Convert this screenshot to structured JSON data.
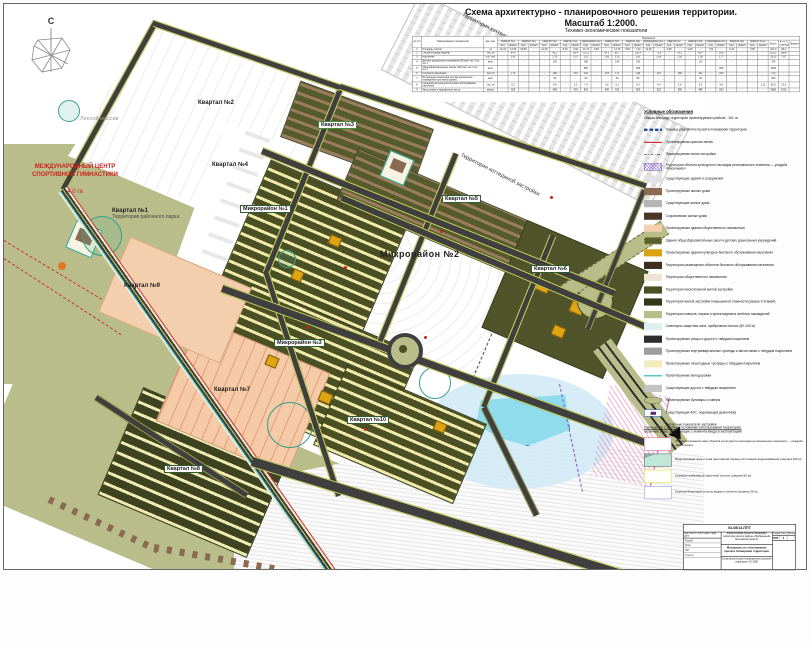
{
  "title": {
    "line1": "Схема архитектурно - планировочного решения территории.",
    "line2": "Масштаб 1:2000.",
    "table_caption": "Технико-экономические показатели"
  },
  "compass": {
    "north": "С"
  },
  "map": {
    "labels": [
      {
        "text": "Квартал №2",
        "x": 194,
        "y": 96,
        "cls": "plain"
      },
      {
        "text": "Квартал №4",
        "x": 208,
        "y": 158,
        "cls": "plain"
      },
      {
        "text": "Квартал №1",
        "sub": "Территория районного парка",
        "x": 108,
        "y": 204,
        "cls": "plain"
      },
      {
        "text": "Квартал №3",
        "x": 314,
        "y": 117,
        "cls": "gbox"
      },
      {
        "text": "Квартал №9",
        "x": 120,
        "y": 279,
        "cls": "plain"
      },
      {
        "text": "Квартал №5",
        "x": 438,
        "y": 191,
        "cls": "dbox"
      },
      {
        "text": "Квартал №6",
        "x": 527,
        "y": 261,
        "cls": "dbox"
      },
      {
        "text": "Квартал №7",
        "x": 210,
        "y": 383,
        "cls": "plain"
      },
      {
        "text": "Квартал №8",
        "x": 160,
        "y": 461,
        "cls": "dbox"
      },
      {
        "text": "Квартал №10",
        "x": 343,
        "y": 412,
        "cls": "dbox"
      },
      {
        "text": "Микрорайон №1",
        "x": 236,
        "y": 201,
        "cls": "dbox"
      },
      {
        "text": "Микрорайон №2",
        "x": 376,
        "y": 246,
        "cls": "big"
      },
      {
        "text": "Микрорайон №3",
        "x": 270,
        "y": 335,
        "cls": "dbox"
      },
      {
        "text": "Территория коттеджного поселка «Людмила»",
        "x": 452,
        "y": 34,
        "cls": "rotated",
        "rot": 27
      },
      {
        "text": "Территория коттеджной застройки",
        "x": 452,
        "y": 168,
        "cls": "rotated",
        "rot": 27
      },
      {
        "text": "Лесной массив",
        "x": 76,
        "y": 112,
        "cls": "forest"
      }
    ],
    "intl_center": {
      "line1": "МЕЖДУНАРОДНЫЙ ЦЕНТР",
      "line2": "СПОРТИВНОЙ ГИМНАСТИКИ",
      "area": "4,0 га"
    }
  },
  "table": {
    "top_header": "Показатели",
    "corner_headers": [
      "№ п/п",
      "Наименование показателей",
      "Ед. изм."
    ],
    "sub_cycle": [
      "сущ.",
      "проект."
    ],
    "groups": [
      {
        "label": "Квартал №1",
        "span": 2
      },
      {
        "label": "Квартал №2",
        "span": 2
      },
      {
        "label": "Квартал №3",
        "span": 2
      },
      {
        "label": "Квартал №4",
        "span": 2
      },
      {
        "label": "Микрорайон №1",
        "span": 2
      },
      {
        "label": "Квартал №5",
        "span": 2
      },
      {
        "label": "Квартал №6",
        "span": 2
      },
      {
        "label": "Микрорайон №2",
        "span": 2
      },
      {
        "label": "Квартал №7",
        "span": 2
      },
      {
        "label": "Квартал №8",
        "span": 2
      },
      {
        "label": "Микрорайон №3",
        "span": 2
      },
      {
        "label": "Квартал №9",
        "span": 2
      },
      {
        "label": "Квартал №10",
        "span": 2
      },
      {
        "label": "Всего",
        "span": 1
      },
      {
        "label": "в т.ч. 1 очередь",
        "span": 1
      },
      {
        "label": "Примечание",
        "span": 1
      }
    ],
    "rows": [
      {
        "num": "1",
        "name": "Площадь участка",
        "unit": "га",
        "values": [
          "10,44",
          "13,96",
          "63,80",
          "-",
          "12,08",
          "-",
          "8,20",
          "4,66",
          "10,73",
          "9,66",
          "-",
          "14,78",
          "5,95",
          "7,40",
          "12,28",
          "-",
          "4,85",
          "-",
          "9,06",
          "-",
          "7,52",
          "-",
          "6,42",
          "-",
          "3,80",
          "-",
          "161,0",
          "48,2",
          ""
        ]
      },
      {
        "num": "2",
        "name": "Общая площадь квартир",
        "unit": "тыс. м²",
        "values": [
          "-",
          "84,6",
          "-",
          "-",
          "-",
          "96,2",
          "-",
          "58,4",
          "112,5",
          "-",
          "64,2",
          "88,7",
          "-",
          "126,4",
          "-",
          "72,8",
          "-",
          "54,2",
          "-",
          "68,4",
          "-",
          "96,8",
          "-",
          "-",
          "-",
          "-",
          "823,2",
          "268,4",
          ""
        ]
      },
      {
        "num": "3",
        "name": "Население",
        "unit": "тыс. чел.",
        "values": [
          "-",
          "2,42",
          "-",
          "-",
          "-",
          "2,75",
          "-",
          "1,67",
          "3,21",
          "-",
          "1,83",
          "2,53",
          "-",
          "3,61",
          "-",
          "2,08",
          "-",
          "1,55",
          "-",
          "1,95",
          "-",
          "2,77",
          "-",
          "-",
          "-",
          "-",
          "23,52",
          "7,67",
          ""
        ]
      },
      {
        "num": "4",
        "name": "Детские дошкольные учреждения (55 мест на 1 тыс. чел.)",
        "unit": "мест",
        "values": [
          "-",
          "-",
          "-",
          "-",
          "-",
          "135",
          "-",
          "-",
          "180",
          "-",
          "-",
          "140",
          "-",
          "200",
          "-",
          "-",
          "-",
          "-",
          "-",
          "110",
          "-",
          "-",
          "-",
          "-",
          "-",
          "-",
          "765",
          "-",
          ""
        ]
      },
      {
        "num": "5",
        "name": "Общеобразовательные школы (135 мест на 1 тыс. чел.)",
        "unit": "мест",
        "values": [
          "-",
          "-",
          "-",
          "-",
          "-",
          "-",
          "-",
          "-",
          "550",
          "-",
          "-",
          "-",
          "-",
          "825",
          "-",
          "-",
          "-",
          "-",
          "-",
          "-",
          "-",
          "550",
          "-",
          "-",
          "-",
          "-",
          "1925",
          "-",
          ""
        ]
      },
      {
        "num": "6",
        "name": "Плотность населения",
        "unit": "чел./га",
        "values": [
          "-",
          "173",
          "-",
          "-",
          "-",
          "186",
          "-",
          "204",
          "192",
          "-",
          "178",
          "171",
          "-",
          "146",
          "-",
          "210",
          "-",
          "168",
          "-",
          "162",
          "-",
          "184",
          "-",
          "-",
          "-",
          "-",
          "176",
          "-",
          ""
        ]
      },
      {
        "num": "7",
        "name": "Встроенные помещения детских дошкольных учреждений (при жилых домах)",
        "unit": "мест",
        "values": [
          "-",
          "-",
          "-",
          "-",
          "-",
          "40",
          "-",
          "-",
          "60",
          "-",
          "-",
          "40",
          "-",
          "80",
          "-",
          "-",
          "-",
          "-",
          "-",
          "40",
          "-",
          "-",
          "-",
          "-",
          "-",
          "-",
          "260",
          "-",
          ""
        ]
      },
      {
        "num": "8",
        "name": "Предприятия культурно-бытового обслуживания населения",
        "unit": "тыс. м²",
        "values": [
          "-",
          "6,2",
          "-",
          "-",
          "-",
          "4,8",
          "-",
          "3,2",
          "7,4",
          "-",
          "3,6",
          "5,1",
          "-",
          "8,2",
          "-",
          "4,4",
          "-",
          "2,8",
          "-",
          "3,5",
          "-",
          "5,6",
          "-",
          "-",
          "-",
          "1,12",
          "56,0",
          "12,6",
          ""
        ]
      },
      {
        "num": "9",
        "name": "Автостоянки и парковочные места",
        "unit": "м/мест",
        "values": [
          "-",
          "605",
          "-",
          "-",
          "-",
          "688",
          "-",
          "418",
          "803",
          "-",
          "458",
          "633",
          "-",
          "903",
          "-",
          "520",
          "-",
          "388",
          "-",
          "488",
          "-",
          "693",
          "-",
          "-",
          "-",
          "-",
          "5880",
          "1916",
          ""
        ]
      }
    ]
  },
  "legend": {
    "header": "Условные обозначения",
    "area_note": "Общая площадь территории проектируемого района - 161 га",
    "items": [
      {
        "sw": "sw-blue-dash",
        "line": true,
        "label": "Граница разработки проекта планировки территории"
      },
      {
        "sw": "sw-red",
        "line": true,
        "label": "Проектируемая красная линия"
      },
      {
        "sw": "sw-dashdot",
        "line": true,
        "label": "Проектируемая линия застройки"
      },
      {
        "sw": "sw-hatch-purple",
        "label": "Территория объекта культурного наследия регионального значения — усадьба «Васильево»"
      },
      {
        "sw": "sw-ltgray",
        "label": "Существующие здания и сооружения"
      },
      {
        "sw": "sw-brown",
        "label": "Проектируемые жилые дома"
      },
      {
        "sw": "sw-gray",
        "label": "Существующие жилые дома"
      },
      {
        "sw": "sw-dkbrown",
        "label": "Сохраняемые жилые дома"
      },
      {
        "sw": "sw-peach",
        "label": "Проектируемые здания общественного назначения"
      },
      {
        "sw": "sw-olive-dash",
        "label": "Здания общеобразовательных школ и детских дошкольных учреждений"
      },
      {
        "sw": "sw-gold",
        "label": "Проектируемые здания культурно-бытового обслуживания населения"
      },
      {
        "sw": "sw-dkbrown2",
        "label": "Территория размещения объектов бытового обслуживания населения"
      },
      {
        "sw": "sw-cream",
        "label": "Территория общественного назначения"
      },
      {
        "sw": "sw-dkolive",
        "label": "Территория многоэтажной жилой застройки"
      },
      {
        "sw": "sw-dkolive2",
        "label": "Территория жилой застройки повышенной этажности (свыше 9 этажей)"
      },
      {
        "sw": "sw-khaki",
        "label": "Территория скверов, парков и проектируемых зелёных насаждений"
      },
      {
        "sw": "sw-ltcyan",
        "label": "Санитарно-защитная зона, прибрежная полоса (50-100 м)"
      },
      {
        "sw": "sw-black",
        "label": "Проектируемые улицы и дороги с твёрдым покрытием"
      },
      {
        "sw": "sw-midgray",
        "label": "Проектируемые внутриквартальные проезды и автостоянки с твёрдым покрытием"
      },
      {
        "sw": "sw-paleyellow",
        "label": "Проектируемые пешеходные тротуары с твёрдым покрытием"
      },
      {
        "sw": "sw-cyan",
        "line": true,
        "label": "Проектируемые велодорожки"
      },
      {
        "sw": "sw-gray2",
        "label": "Существующие дороги с твёрдым покрытием"
      },
      {
        "sw": "sw-oval",
        "label": "Проектируемые бульвары и скверы"
      },
      {
        "sw": "sw-azs",
        "label": "Существующая АЗС, подлежащая демонтажу"
      },
      {
        "sw": "sw-none",
        "label": "Расчётные показатели застройки"
      }
    ],
    "zones_header_1": "Границы зон с особыми условиями использования территории:",
    "zones_header_2": "охранные зоны, действующие с момента ввода в эксплуатацию",
    "zones": [
      {
        "sw": "sw2-pink",
        "label": "Граница охранной зоны объекта культурного наследия регионального значения — усадьба «Васильево»"
      },
      {
        "sw": "sw2-wz",
        "label": "Водоохранная зона и зона санитарной охраны источников водоснабжения (ширина 100 м)"
      },
      {
        "sw": "sw2-yellow",
        "label": "Граница прибрежной защитной полосы (ширина 50 м)"
      },
      {
        "sw": "sw2-lav",
        "label": "Граница береговой полосы водного объекта (ширина 20 м)"
      }
    ]
  },
  "stamp": {
    "doc_number": "04-08/14-ППТ",
    "cols_header": "Изм.  Кол.уч.  Лист  №док.  Подп.  Дата",
    "sign_rows": [
      {
        "label": "Разраб."
      },
      {
        "label": "Пров."
      },
      {
        "label": "ГАП"
      },
      {
        "label": "Н.контр."
      }
    ],
    "project": "Корректировка проекта планировки территории жилого района «Прибрежный» Московской области",
    "doc_title": "Материалы по обоснованию проекта планировки территории",
    "sheet_name": "Схема архитектурно-планировочного решения территории. М 1:2000",
    "stage_label": "Стадия",
    "sheet_label": "Лист",
    "sheets_label": "Листов",
    "stage": "ППТ",
    "sheet": "4",
    "sheets": ""
  }
}
